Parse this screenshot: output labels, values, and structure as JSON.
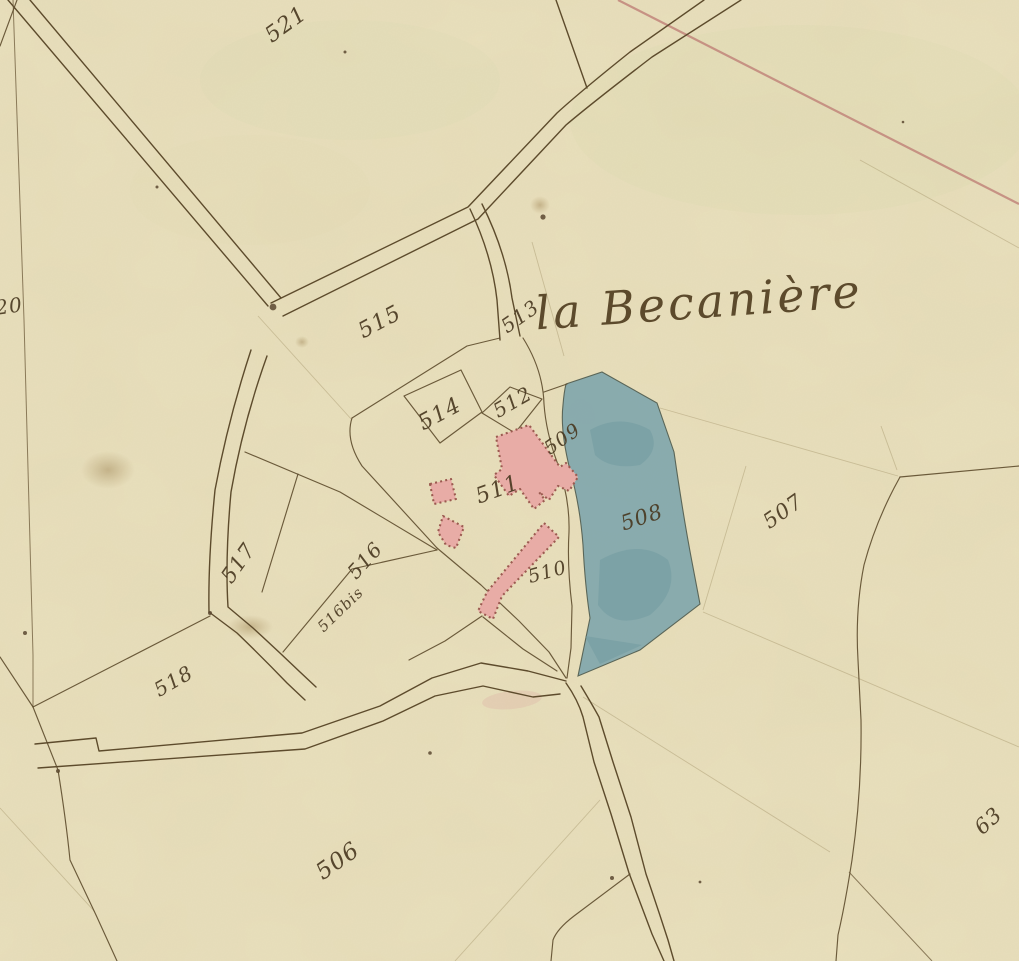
{
  "place": {
    "name": "la Becanière"
  },
  "parcel_labels": [
    {
      "id": "521",
      "text": "521",
      "x": 290,
      "y": 30,
      "rot": -36,
      "size": 22
    },
    {
      "id": "520-partial",
      "text": "20",
      "x": 10,
      "y": 313,
      "rot": -8,
      "size": 20
    },
    {
      "id": "515",
      "text": "515",
      "x": 383,
      "y": 328,
      "rot": -28,
      "size": 22
    },
    {
      "id": "513",
      "text": "513",
      "x": 524,
      "y": 322,
      "rot": -35,
      "size": 20
    },
    {
      "id": "514",
      "text": "514",
      "x": 443,
      "y": 420,
      "rot": -28,
      "size": 22
    },
    {
      "id": "512",
      "text": "512",
      "x": 516,
      "y": 408,
      "rot": -30,
      "size": 20
    },
    {
      "id": "509",
      "text": "509",
      "x": 566,
      "y": 444,
      "rot": -35,
      "size": 19
    },
    {
      "id": "511",
      "text": "511",
      "x": 500,
      "y": 496,
      "rot": -20,
      "size": 22
    },
    {
      "id": "510",
      "text": "510",
      "x": 549,
      "y": 578,
      "rot": -15,
      "size": 19
    },
    {
      "id": "508",
      "text": "508",
      "x": 644,
      "y": 524,
      "rot": -18,
      "size": 21
    },
    {
      "id": "507",
      "text": "507",
      "x": 787,
      "y": 517,
      "rot": -35,
      "size": 21
    },
    {
      "id": "517",
      "text": "517",
      "x": 244,
      "y": 567,
      "rot": -55,
      "size": 21
    },
    {
      "id": "516",
      "text": "516",
      "x": 370,
      "y": 565,
      "rot": -48,
      "size": 20
    },
    {
      "id": "516bis",
      "text": "516bis",
      "x": 344,
      "y": 613,
      "rot": -44,
      "size": 15
    },
    {
      "id": "518",
      "text": "518",
      "x": 177,
      "y": 687,
      "rot": -30,
      "size": 20
    },
    {
      "id": "506",
      "text": "506",
      "x": 342,
      "y": 867,
      "rot": -35,
      "size": 23
    },
    {
      "id": "630-partial",
      "text": "63",
      "x": 993,
      "y": 826,
      "rot": -42,
      "size": 21
    }
  ],
  "colors": {
    "paper": "#e9e0bd",
    "ink": "#4a3a22",
    "road_line": "#5d4b2c",
    "red_boundary_line": "#c1857a",
    "blue_parcel_fill": "#82a7ad",
    "building_fill": "#e8aca6",
    "building_edge": "#9b5a50"
  },
  "features": {
    "blue_parcel_id": "508",
    "pink_building_area_ids": [
      "511",
      "510"
    ],
    "red_line_present": "diagonal red boundary line in top-right quadrant"
  }
}
